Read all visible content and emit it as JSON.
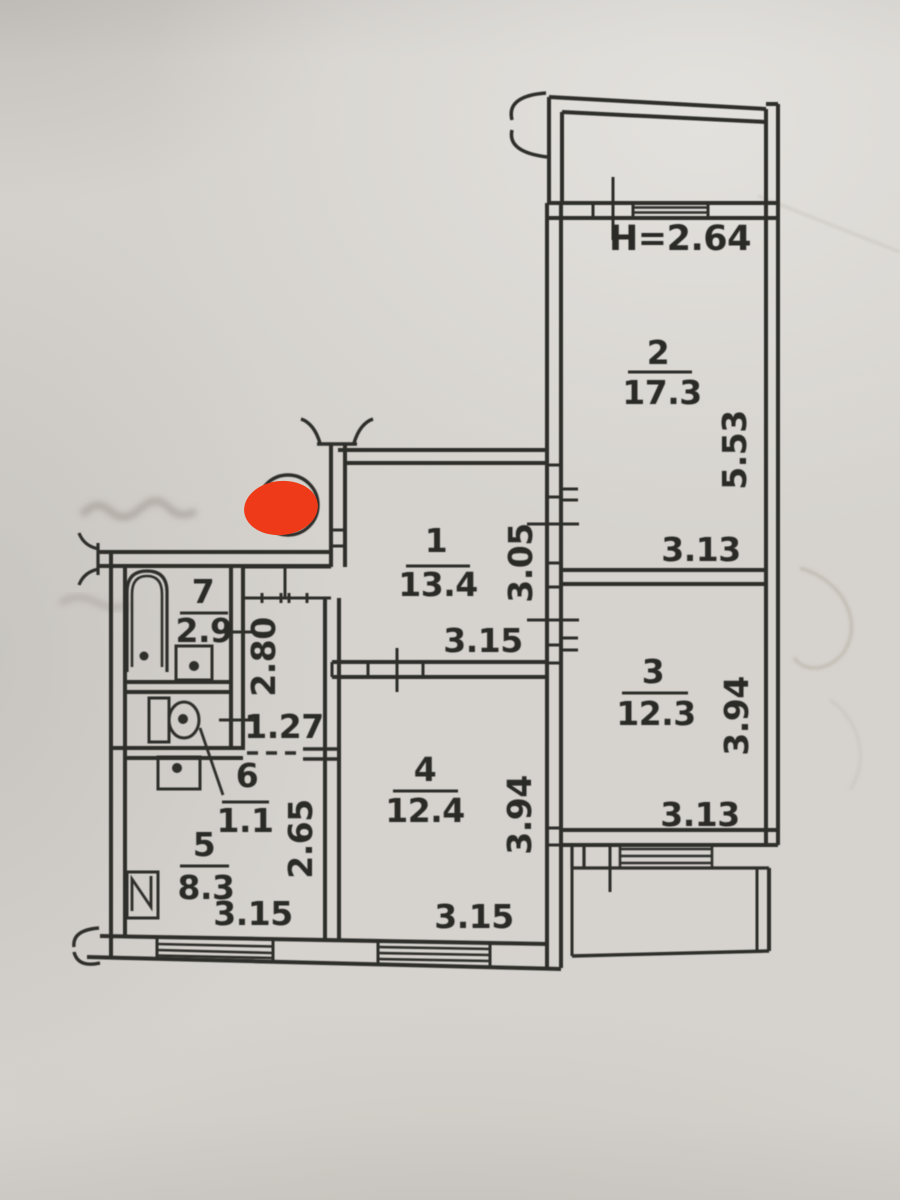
{
  "plan": {
    "height_label": "H=2.64",
    "rooms": [
      {
        "id": "1",
        "area": "13.4"
      },
      {
        "id": "2",
        "area": "17.3"
      },
      {
        "id": "3",
        "area": "12.3"
      },
      {
        "id": "4",
        "area": "12.4"
      },
      {
        "id": "5",
        "area": "8.3"
      },
      {
        "id": "6",
        "area": "1.1"
      },
      {
        "id": "7",
        "area": "2.9"
      }
    ],
    "dimensions": {
      "room1_width": "3.15",
      "room1_depth": "3.05",
      "room2_width": "3.13",
      "room2_depth": "5.53",
      "room3_width": "3.13",
      "room3_depth": "3.94",
      "room4_width": "3.15",
      "room4_depth": "3.94",
      "kitchen_width": "3.15",
      "kitchen_depth": "2.65",
      "hallway_depth": "2.80",
      "hallway_width": "1.27"
    },
    "colors": {
      "marker": "#ee3a18",
      "ink": "#2f2d29",
      "paper": "#d6d3ce"
    }
  }
}
